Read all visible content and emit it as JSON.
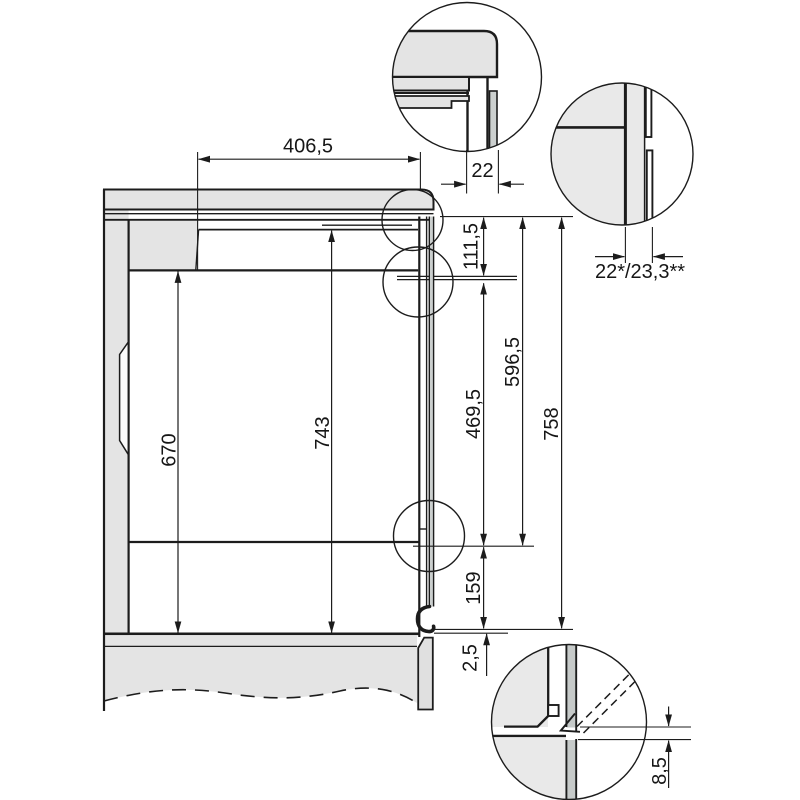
{
  "dims": {
    "top_depth": "406,5",
    "front_thickness": "22",
    "side_panel_thickness": "22*/23,3**",
    "upper_front_height": "111,5",
    "door_height": "469,5",
    "front_height": "596,5",
    "interior_height": "743",
    "niche_height": "670",
    "total_height": "758",
    "plinth_height": "159",
    "bottom_offset": "2,5",
    "floor_gap": "8,5"
  },
  "colors": {
    "line": "#1c1c1c",
    "panel": "#e4e4e4",
    "detail_panel": "#e9e9e9",
    "door_face": "#c6cac9",
    "background": "#ffffff"
  }
}
